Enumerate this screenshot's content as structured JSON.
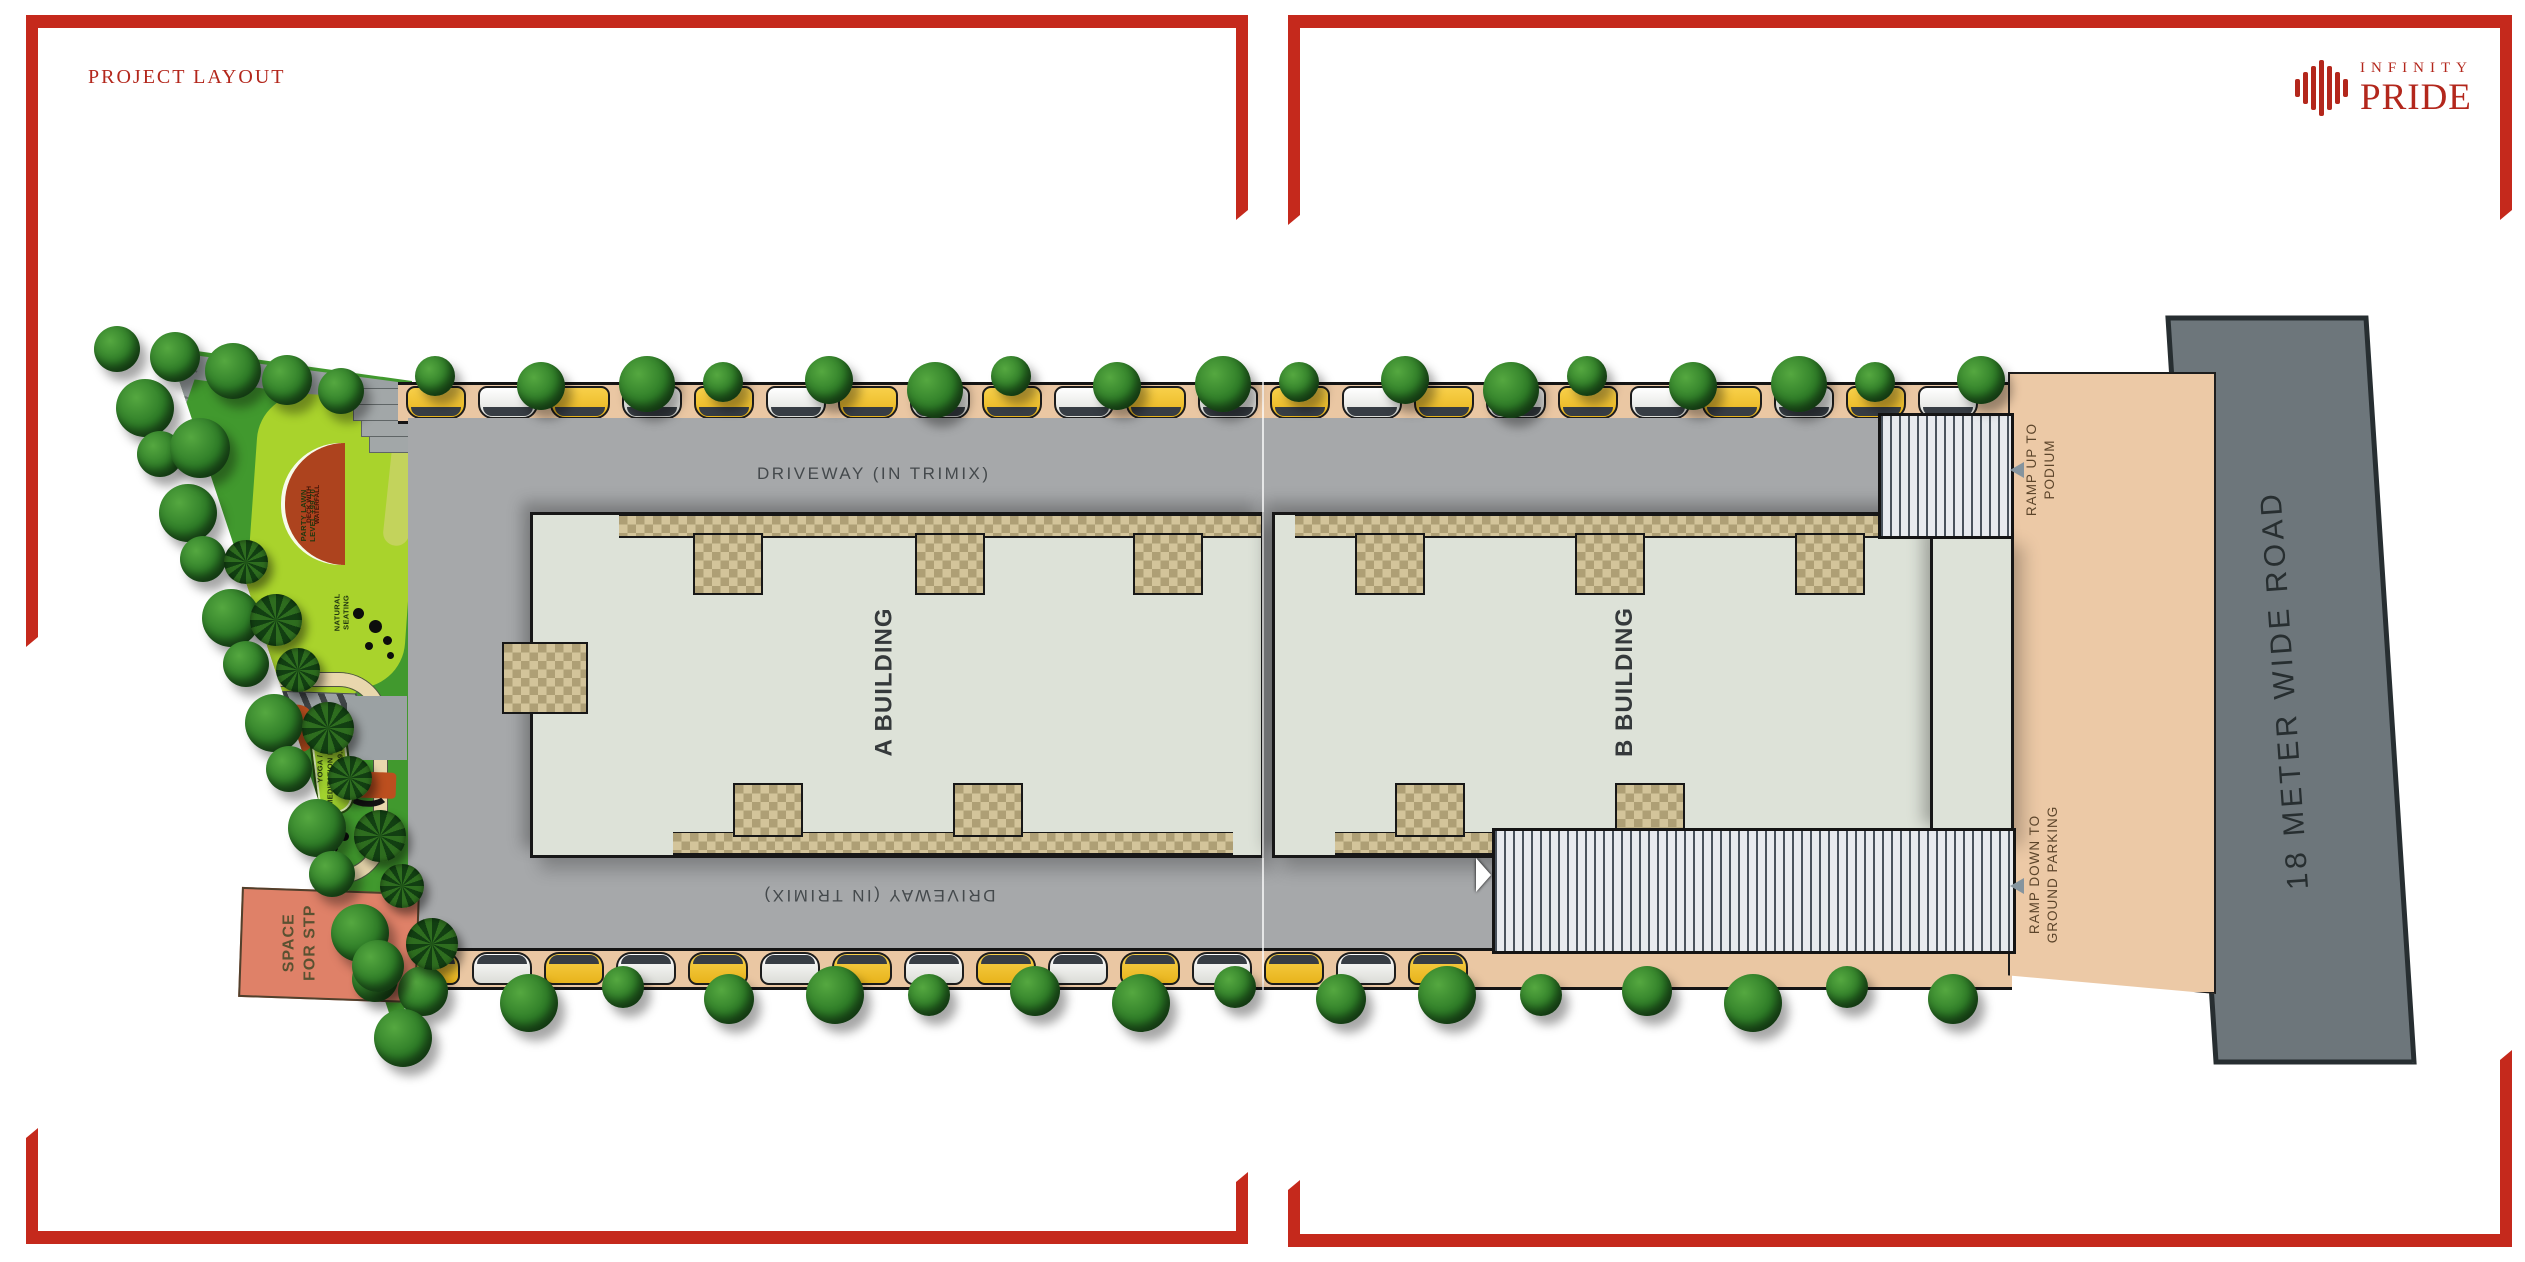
{
  "page": {
    "title": "PROJECT LAYOUT"
  },
  "brand": {
    "name_line1": "INFINITY",
    "name_line2": "PRIDE",
    "logo_icon": "building-bars-circle-icon"
  },
  "plan": {
    "driveway_top": "DRIVEWAY (IN TRIMIX)",
    "driveway_bottom": "DRIVEWAY (IN TRIMIX)",
    "building_a": "A BUILDING",
    "building_b": "B BUILDING",
    "ramp_up": {
      "line1": "RAMP UP TO",
      "line2": "PODIUM"
    },
    "ramp_down": {
      "line1": "RAMP DOWN TO",
      "line2": "GROUND PARKING"
    },
    "road": "18 METER WIDE ROAD",
    "stp": {
      "line1": "SPACE",
      "line2": "FOR STP"
    },
    "green": {
      "jogging": "JOGGING TRACK",
      "deck": {
        "line1": "DECK WITH",
        "line2": "WATERFALL"
      },
      "party": {
        "line1": "PARTY LAWN",
        "line2": "LEVEL +99.70"
      },
      "natural": {
        "line1": "NATURAL",
        "line2": "SEATING"
      },
      "kids": {
        "line1": "KIDS PLAY PARK",
        "line2": "LEVEL +99.70"
      },
      "activity": {
        "line1": "ACTIVITY",
        "line2": "AREA"
      },
      "senior": {
        "line1": "SENIOR CITIZEN",
        "line2": "AREA"
      },
      "yoga": {
        "line1": "YOGA /",
        "line2": "MEDITATION LAWN",
        "line3": "LEVEL +99.00"
      },
      "acupressure": "ACUPRESSURE PARK"
    }
  },
  "colors": {
    "frame_red": "#c5291c",
    "brand_red": "#b3271c",
    "driveway_grey": "#a6a8aa",
    "building_sage": "#dde2d8",
    "parking_beige": "#eac7a3",
    "podium_peach": "#ecc9a6",
    "road_grey": "#6d767b",
    "lawn_green": "#a9d32c",
    "base_green": "#41992e",
    "terracotta": "#ad431e",
    "stp_salmon": "#df8168"
  },
  "decor": {
    "top_trees": 17,
    "top_cars": 22,
    "bottom_trees": 16,
    "bottom_cars": 15,
    "boundary_trees": 14,
    "palm_trees": 8,
    "car_colors": [
      "yellow",
      "white"
    ]
  }
}
